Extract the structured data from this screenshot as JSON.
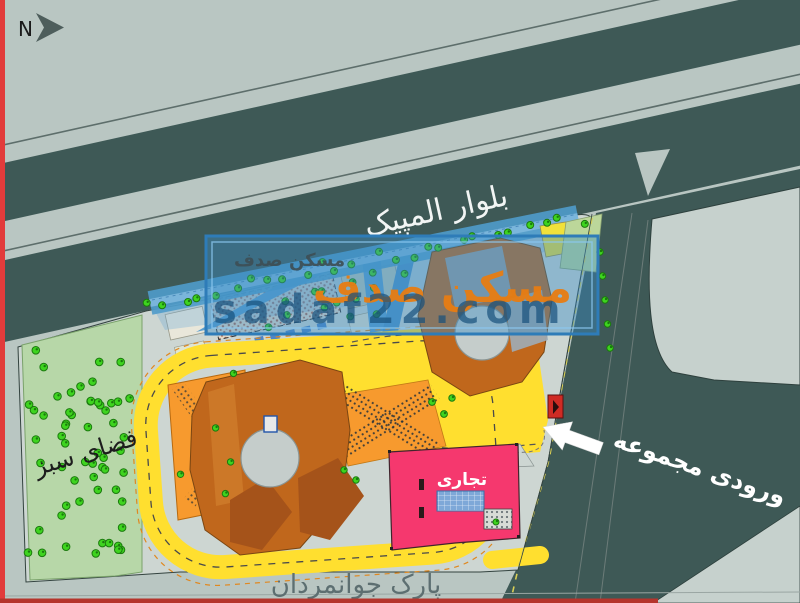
{
  "north_indicator": {
    "label": "N"
  },
  "map_labels": {
    "boulevard": "بلوار المپیک",
    "green_space": "فضای سبز",
    "commercial": "تجاری",
    "entrance": "ورودی مجموعه",
    "park": "پارک جوانمردان"
  },
  "watermark": {
    "brand_small": "مسکن صدف",
    "brand_large": "مسکن صدف",
    "url": "sadaf22.com"
  },
  "colors": {
    "frame_red": "#e23b3b",
    "highway_dark": "#3e5956",
    "background": "#b9c6c2",
    "site_ground": "#cdd6d2",
    "green_space_fill": "#b7d7a8",
    "tree_green": "#3ed41f",
    "tree_dark": "#1b7a0e",
    "road_yellow": "#ffdf2f",
    "plaza_orange": "#f79a2e",
    "building_orange": "#c0671c",
    "building_dark_orange": "#a5531a",
    "commercial_pink": "#f5386e",
    "courtyard_gray": "#c5cdcb",
    "water_blue": "#5b9fd0",
    "watermark_blue": "rgba(58,140,198,0.42)",
    "watermark_orange": "#e87d12"
  }
}
